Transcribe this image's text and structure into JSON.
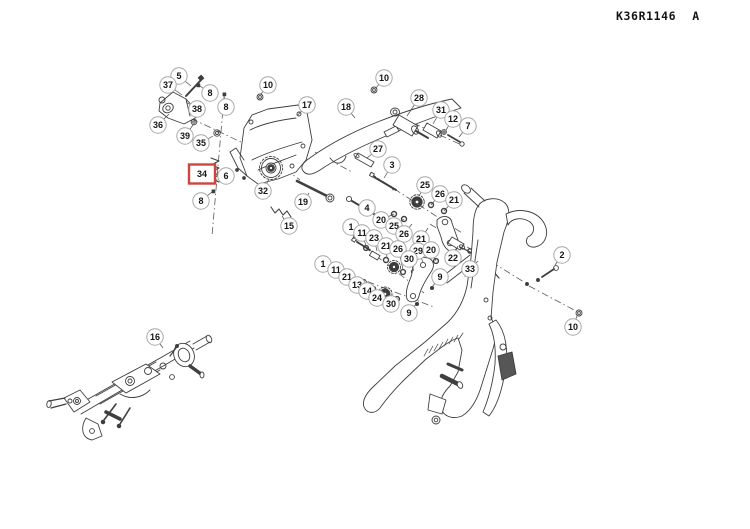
{
  "window": {
    "part_code": "K36R1146",
    "revision": "A"
  },
  "colors": {
    "background": "#ffffff",
    "line": "#3f3f3f",
    "dark_fill": "#3d3d3d",
    "callout_stroke": "#a8a8a8",
    "callout_fill": "#ffffff",
    "callout_text": "#151515",
    "highlight": "#cf4440",
    "leader": "#4a4a4a"
  },
  "diagram": {
    "highlighted_callout": "34",
    "callouts": [
      {
        "label": "5",
        "x": 179,
        "y": 76,
        "tx": 191,
        "ty": 86
      },
      {
        "label": "37",
        "x": 168,
        "y": 85,
        "tx": 182,
        "ty": 95
      },
      {
        "label": "8",
        "x": 210,
        "y": 93,
        "tx": 200,
        "ty": 86
      },
      {
        "label": "38",
        "x": 197,
        "y": 109,
        "tx": 186,
        "ty": 102
      },
      {
        "label": "8",
        "x": 226,
        "y": 107,
        "tx": 224,
        "ty": 96
      },
      {
        "label": "36",
        "x": 158,
        "y": 125,
        "tx": 169,
        "ty": 114
      },
      {
        "label": "39",
        "x": 185,
        "y": 136,
        "tx": 193,
        "ty": 125
      },
      {
        "label": "35",
        "x": 201,
        "y": 143,
        "tx": 213,
        "ty": 136
      },
      {
        "label": "34",
        "x": 202,
        "y": 174,
        "tx": 211,
        "ty": 170,
        "style": "box"
      },
      {
        "label": "6",
        "x": 226,
        "y": 176,
        "tx": 219,
        "ty": 172
      },
      {
        "label": "8",
        "x": 201,
        "y": 201,
        "tx": 212,
        "ty": 192
      },
      {
        "label": "10",
        "x": 268,
        "y": 85,
        "tx": 261,
        "ty": 94
      },
      {
        "label": "17",
        "x": 307,
        "y": 105,
        "tx": 297,
        "ty": 116
      },
      {
        "label": "18",
        "x": 346,
        "y": 107,
        "tx": 355,
        "ty": 118
      },
      {
        "label": "10",
        "x": 384,
        "y": 78,
        "tx": 376,
        "ty": 88
      },
      {
        "label": "28",
        "x": 419,
        "y": 98,
        "tx": 407,
        "ty": 116
      },
      {
        "label": "31",
        "x": 441,
        "y": 110,
        "tx": 433,
        "ty": 124
      },
      {
        "label": "12",
        "x": 453,
        "y": 119,
        "tx": 446,
        "ty": 130
      },
      {
        "label": "7",
        "x": 468,
        "y": 126,
        "tx": 459,
        "ty": 137
      },
      {
        "label": "27",
        "x": 378,
        "y": 149,
        "tx": 367,
        "ty": 158
      },
      {
        "label": "3",
        "x": 392,
        "y": 165,
        "tx": 384,
        "ty": 178
      },
      {
        "label": "4",
        "x": 367,
        "y": 208,
        "tx": 359,
        "ty": 204
      },
      {
        "label": "32",
        "x": 263,
        "y": 191,
        "tx": 269,
        "ty": 179
      },
      {
        "label": "19",
        "x": 303,
        "y": 202,
        "tx": 309,
        "ty": 193
      },
      {
        "label": "15",
        "x": 289,
        "y": 226,
        "tx": 282,
        "ty": 216
      },
      {
        "label": "25",
        "x": 425,
        "y": 185,
        "tx": 419,
        "ty": 196
      },
      {
        "label": "26",
        "x": 440,
        "y": 194,
        "tx": 431,
        "ty": 205
      },
      {
        "label": "21",
        "x": 454,
        "y": 200,
        "tx": 444,
        "ty": 211
      },
      {
        "label": "20",
        "x": 381,
        "y": 220,
        "tx": 394,
        "ty": 214
      },
      {
        "label": "25",
        "x": 394,
        "y": 226,
        "tx": 404,
        "ty": 219
      },
      {
        "label": "26",
        "x": 404,
        "y": 234,
        "tx": 412,
        "ty": 224
      },
      {
        "label": "21",
        "x": 421,
        "y": 239,
        "tx": 428,
        "ty": 228
      },
      {
        "label": "1",
        "x": 351,
        "y": 227,
        "tx": 354,
        "ty": 239
      },
      {
        "label": "11",
        "x": 362,
        "y": 233,
        "tx": 366,
        "ty": 246
      },
      {
        "label": "23",
        "x": 374,
        "y": 238,
        "tx": 377,
        "ty": 251
      },
      {
        "label": "21",
        "x": 386,
        "y": 246,
        "tx": 387,
        "ty": 258
      },
      {
        "label": "26",
        "x": 398,
        "y": 249,
        "tx": 403,
        "ty": 269
      },
      {
        "label": "29",
        "x": 418,
        "y": 251,
        "tx": 423,
        "ty": 262
      },
      {
        "label": "20",
        "x": 431,
        "y": 250,
        "tx": 436,
        "ty": 261
      },
      {
        "label": "30",
        "x": 409,
        "y": 259,
        "tx": 414,
        "ty": 271
      },
      {
        "label": "22",
        "x": 453,
        "y": 258,
        "tx": 458,
        "ty": 246
      },
      {
        "label": "33",
        "x": 470,
        "y": 269,
        "tx": 478,
        "ty": 261
      },
      {
        "label": "9",
        "x": 440,
        "y": 277,
        "tx": 432,
        "ty": 287
      },
      {
        "label": "1",
        "x": 323,
        "y": 264,
        "tx": 330,
        "ty": 268
      },
      {
        "label": "11",
        "x": 336,
        "y": 270,
        "tx": 342,
        "ty": 274
      },
      {
        "label": "21",
        "x": 347,
        "y": 277,
        "tx": 352,
        "ty": 280
      },
      {
        "label": "13",
        "x": 357,
        "y": 285,
        "tx": 362,
        "ty": 284
      },
      {
        "label": "14",
        "x": 367,
        "y": 291,
        "tx": 372,
        "ty": 289
      },
      {
        "label": "24",
        "x": 377,
        "y": 298,
        "tx": 382,
        "ty": 295
      },
      {
        "label": "30",
        "x": 391,
        "y": 304,
        "tx": 396,
        "ty": 300
      },
      {
        "label": "9",
        "x": 409,
        "y": 313,
        "tx": 416,
        "ty": 304
      },
      {
        "label": "2",
        "x": 562,
        "y": 255,
        "tx": 555,
        "ty": 265
      },
      {
        "label": "10",
        "x": 573,
        "y": 327,
        "tx": 577,
        "ty": 316
      },
      {
        "label": "16",
        "x": 155,
        "y": 337,
        "tx": 163,
        "ty": 348
      }
    ]
  }
}
